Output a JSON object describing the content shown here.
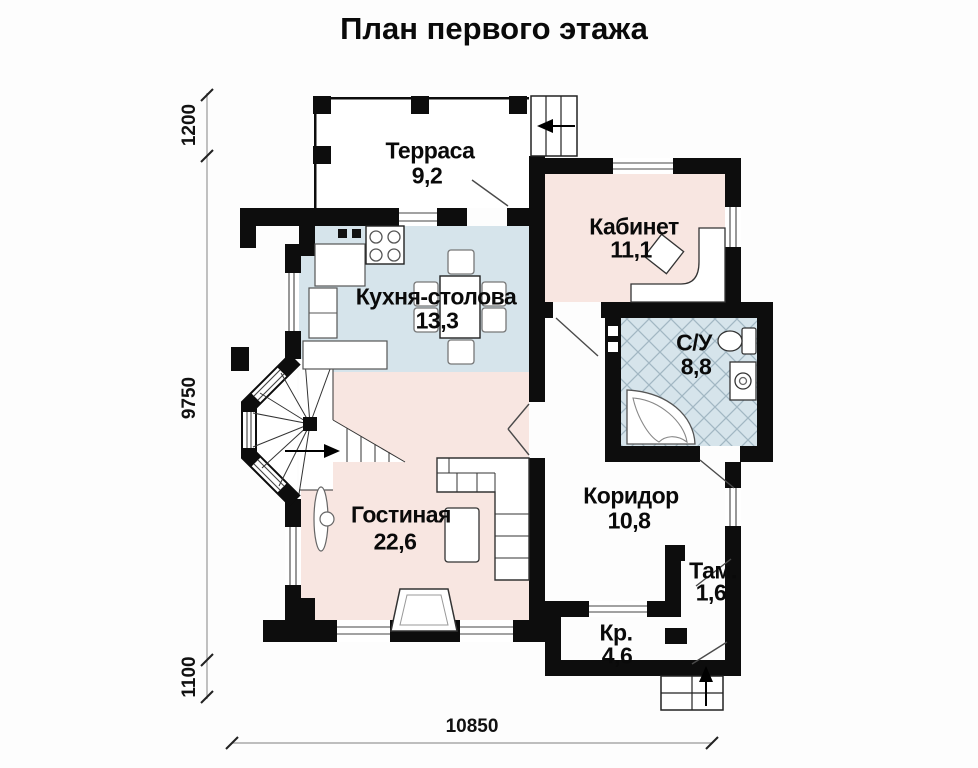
{
  "title": "План первого этажа",
  "rooms": {
    "terrace": {
      "name": "Терраса",
      "area": "9,2"
    },
    "office": {
      "name": "Кабинет",
      "area": "11,1"
    },
    "kitchen_dining": {
      "name": "Кухня-столова",
      "area": "13,3"
    },
    "bathroom": {
      "name": "С/У",
      "area": "8,8"
    },
    "living": {
      "name": "Гостиная",
      "area": "22,6"
    },
    "corridor": {
      "name": "Коридор",
      "area": "10,8"
    },
    "vestibule": {
      "name": "Там.",
      "area": "1,6"
    },
    "porch": {
      "name": "Кр.",
      "area": "4,6"
    }
  },
  "dimensions": {
    "left_top": "1200",
    "left_middle": "9750",
    "left_bottom": "1100",
    "bottom_width": "10850"
  },
  "colors": {
    "wall": "#0d0d0d",
    "room_warm": "#f8e6e1",
    "room_cool": "#d6e4eb",
    "tile_hatch": "#a2b7c3"
  }
}
